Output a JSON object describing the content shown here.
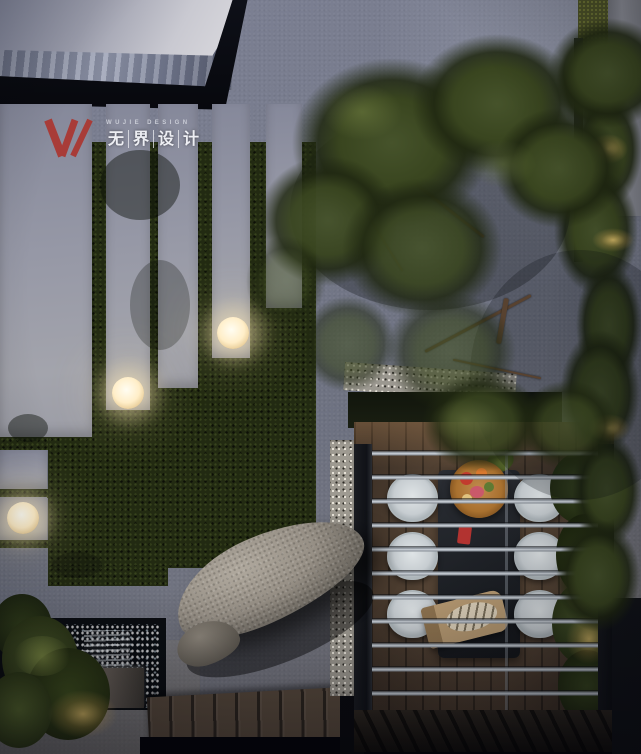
{
  "logo": {
    "en": "WUJIE DESIGN",
    "zh": "无界设计",
    "zh_chars": [
      "无",
      "界",
      "设",
      "计"
    ],
    "mark": "w-slash-monogram",
    "mark_color": "#a83c38"
  },
  "palette": {
    "accent_red": "#a83c38",
    "paving_grey": "#7d8195",
    "paving_light": "#a3a4ac",
    "roof_slab": "#dddce0",
    "roof_edge_black": "#0b0d13",
    "lawn_green": "#222a12",
    "tree_canopy": "#39451f",
    "deck_wood": "#4f3f32",
    "pergola_slat": "#9aa1a9",
    "gravel": "#9e9a91",
    "water_dark": "#0a0d11",
    "lamp_glow": "#ffeec8",
    "chair_white": "#c7cdd1",
    "table_dark": "#1c1f24",
    "boulder_grey": "#968f85"
  },
  "scene": {
    "type": "courtyard-landscape-render",
    "time_of_day": "night",
    "view": "top-down aerial",
    "sphere_lamp_count": 3,
    "dining_chair_count": 6,
    "elements": [
      "building-roof",
      "stone-paving",
      "paving-strip-steps",
      "lawn",
      "sphere-lamps",
      "tree-canopy",
      "pergola",
      "dining-table",
      "dining-chairs",
      "food-platter",
      "bread-board",
      "gravel-strip",
      "boulder",
      "waterfall-feature",
      "ferns",
      "wood-deck",
      "hedge-lights"
    ]
  }
}
